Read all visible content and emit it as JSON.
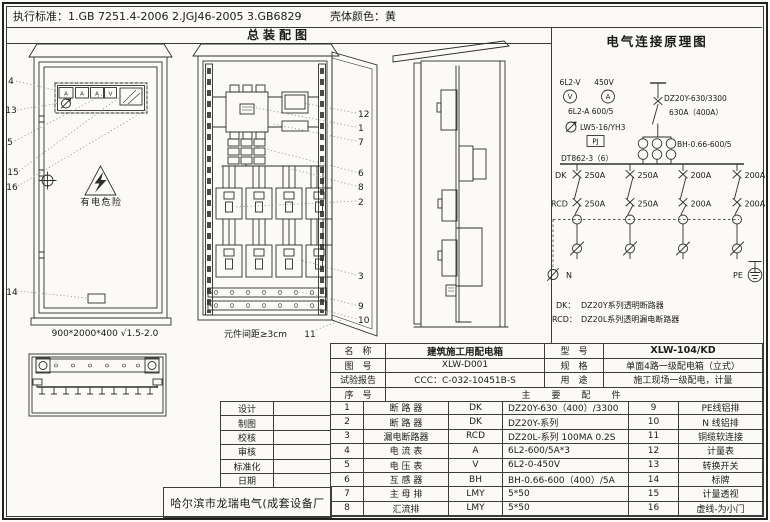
{
  "top_bar": {
    "standards": "执行标准：1.GB 7251.4-2006    2.JGJ46-2005    3.GB6829",
    "shell_color": "壳体颜色：黄"
  },
  "assembly": {
    "title": "总装配图",
    "front": {
      "meters": [
        "A",
        "A",
        "A",
        "V"
      ],
      "warning": "有电危险",
      "dims": "900*2000*400 √1.5-2.0",
      "callouts": [
        "4",
        "13",
        "5",
        "15",
        "16",
        "14"
      ]
    },
    "open": {
      "callouts": [
        "12",
        "1",
        "7",
        "6",
        "8",
        "2",
        "3",
        "9",
        "10",
        "11"
      ],
      "spacing": "元件间距≥3cm"
    }
  },
  "schematic": {
    "title": "电气连接原理图",
    "voltmeter_model": "6L2-V",
    "voltmeter_symbol": "V",
    "ammeter_range": "450V",
    "ammeter_symbol": "A",
    "ammeter_model": "6L2-A 600/5",
    "switch_model": "LW5-16/YH3",
    "meter_box": "PJ",
    "energy_meter": "DT862-3（6）",
    "main_breaker_model": "DZ20Y-630/3300",
    "main_breaker_rating": "630A（400A）",
    "ct_model": "BH-0.66-600/5",
    "dk_label": "DK",
    "rcd_label": "RCD",
    "dk_ratings": [
      "250A",
      "250A",
      "200A",
      "200A"
    ],
    "rcd_ratings": [
      "250A",
      "250A",
      "200A",
      "200A"
    ],
    "n_label": "N",
    "pe_label": "PE",
    "legend_dk_key": "DK：",
    "legend_dk_value": "DZ20Y系列透明断路器",
    "legend_rcd_key": "RCD：",
    "legend_rcd_value": "DZ20L系列透明漏电断路器"
  },
  "title_block": {
    "company": "哈尔滨市龙瑞电气(成套设备厂",
    "sign_labels": [
      "设计",
      "制图",
      "校核",
      "审核",
      "标准化",
      "日期"
    ],
    "header": {
      "name_label": "名　称",
      "name_value": "建筑施工用配电箱",
      "model_label": "型　号",
      "model_value": "XLW-104/KD",
      "drawing_no_label": "图　号",
      "drawing_no_value": "XLW-D001",
      "spec_label": "规　格",
      "spec_value": "单面4路一级配电箱（立式）",
      "report_label": "试验报告",
      "report_value": "CCC：C-032-10451B-S",
      "use_label": "用　途",
      "use_value": "施工现场一级配电，计量",
      "seq_label": "序　号",
      "parts_label": "主　要　配　件"
    },
    "parts": [
      {
        "no": "1",
        "name": "断 路 器",
        "code": "DK",
        "spec": "DZ20Y-630（400）/3300",
        "no2": "9",
        "name2": "PE线铝排"
      },
      {
        "no": "2",
        "name": "断 路 器",
        "code": "DK",
        "spec": "DZ20Y-系列",
        "no2": "10",
        "name2": "N 线铝排"
      },
      {
        "no": "3",
        "name": "漏电断路器",
        "code": "RCD",
        "spec": "DZ20L-系列  100MA 0.2S",
        "no2": "11",
        "name2": "铜缆软连接"
      },
      {
        "no": "4",
        "name": "电 流 表",
        "code": "A",
        "spec": "6L2-600/5A*3",
        "no2": "12",
        "name2": "计量表"
      },
      {
        "no": "5",
        "name": "电 压 表",
        "code": "V",
        "spec": "6L2-0-450V",
        "no2": "13",
        "name2": "转换开关"
      },
      {
        "no": "6",
        "name": "互 感 器",
        "code": "BH",
        "spec": "BH-0.66-600（400）/5A",
        "no2": "14",
        "name2": "标牌"
      },
      {
        "no": "7",
        "name": "主 母 排",
        "code": "LMY",
        "spec": "5*50",
        "no2": "15",
        "name2": "计量透视"
      },
      {
        "no": "8",
        "name": "汇流排",
        "code": "LMY",
        "spec": "5*50",
        "no2": "16",
        "name2": "虚线-为小门"
      }
    ]
  }
}
